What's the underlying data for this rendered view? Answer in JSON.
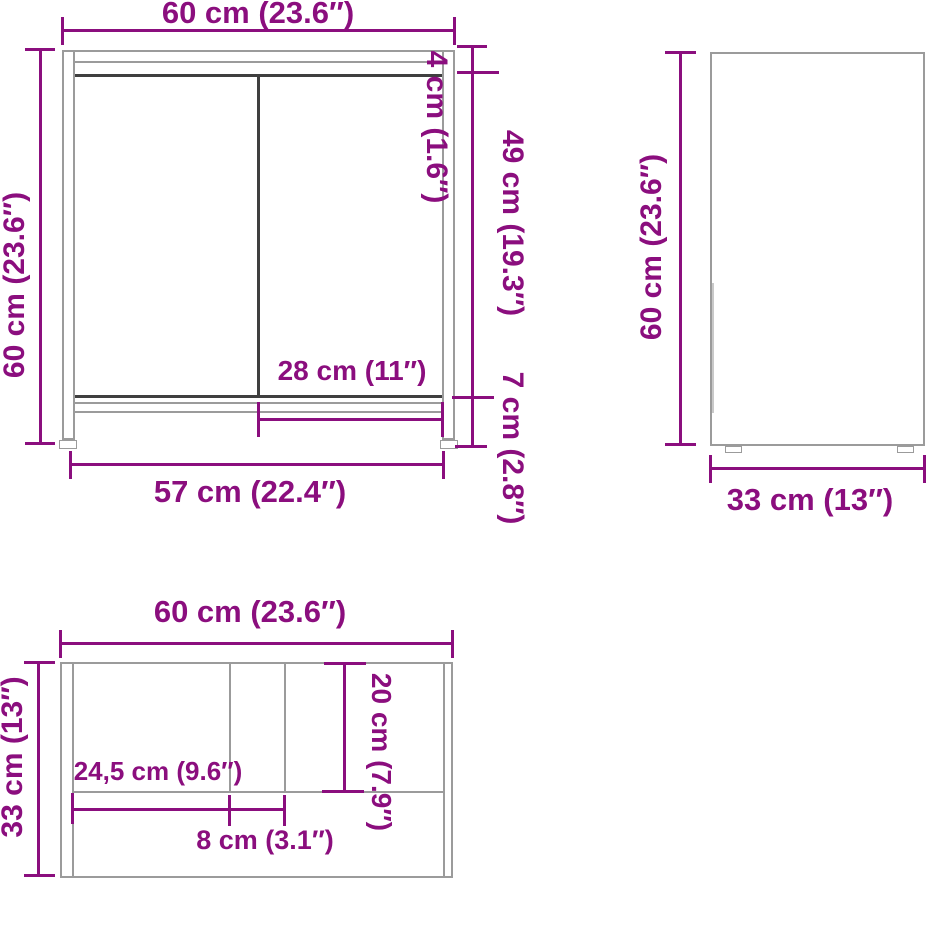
{
  "colors": {
    "dimension_purple": "#8B0E7E",
    "outline_gray": "#9B9B9B",
    "outline_dark": "#3F3F3F",
    "background": "#FFFFFF"
  },
  "views": {
    "front": {
      "width_top": "60 cm (23.6″)",
      "height_left": "60 cm (23.6″)",
      "top_panel_thickness": "4 cm (1.6″)",
      "door_height": "49 cm (19.3″)",
      "leg_height": "7 cm (2.8″)",
      "door_width": "28 cm (11″)",
      "base_width": "57 cm (22.4″)"
    },
    "side": {
      "height_left": "60 cm (23.6″)",
      "depth_bottom": "33 cm (13″)"
    },
    "top": {
      "width_top": "60 cm (23.6″)",
      "depth_left": "33 cm (13″)",
      "cutout_offset": "24,5 cm (9.6″)",
      "cutout_width": "8 cm (3.1″)",
      "cutout_depth": "20 cm (7.9″)"
    }
  }
}
